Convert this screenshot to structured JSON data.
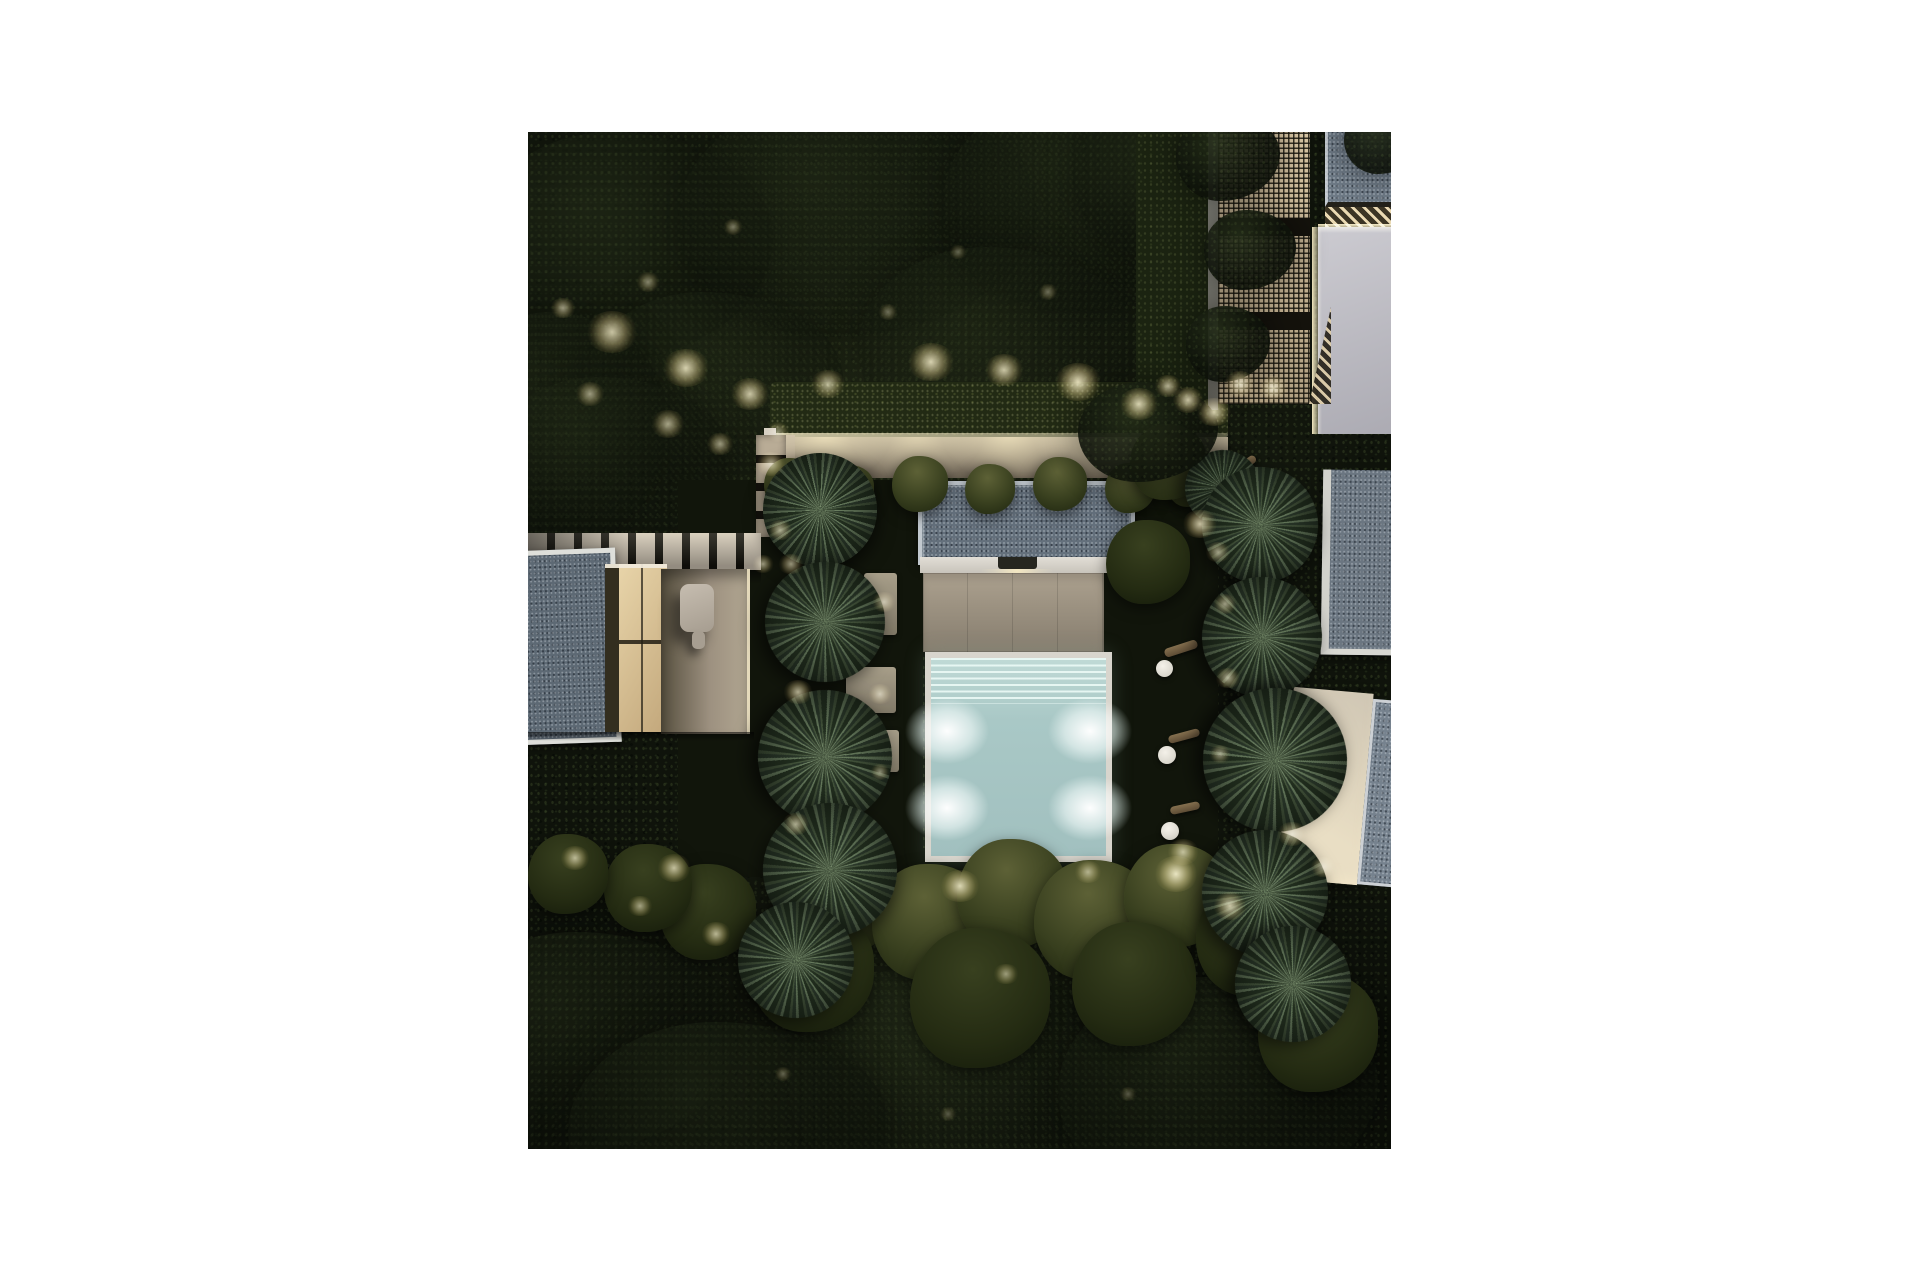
{
  "scene": {
    "caption": "Aerial night render of a modern villa garden: central illuminated pool with stepped entry, beige terrace, slate grey flat roofs, white modular loungers, yucca palm rows, lit hedges, pathways and dense dark tree canopy",
    "photo_rect": {
      "left": 528,
      "top": 132,
      "width": 863,
      "height": 1017
    },
    "palette": {
      "canopy_dark": "#0f130b",
      "lawn": "#11150b",
      "roof_slate": "#64707c",
      "roof_frame": "#c2c9cf",
      "wall_white": "#e2ded6",
      "terrace": "#aca18f",
      "path": "#b3a791",
      "slat_light": "#d3c9b8",
      "pool_coping": "#d8d5cd",
      "pool_water": "#a9c8c6",
      "pool_steps": "#c0dad6",
      "sofa": "#d9d5cb",
      "lattice": "#d8c6a4",
      "pale_wall": "#cccbd1",
      "trunk": "#85704f",
      "glow_core": "#fff6cd"
    },
    "vegetation": {
      "tree_canopies": [
        {
          "x": 95,
          "y": 115,
          "rx": 150,
          "ry": 115,
          "o": 0.5
        },
        {
          "x": 330,
          "y": 85,
          "rx": 180,
          "ry": 120,
          "o": 0.45
        },
        {
          "x": 565,
          "y": 70,
          "rx": 150,
          "ry": 110,
          "o": 0.5
        },
        {
          "x": 185,
          "y": 255,
          "rx": 130,
          "ry": 95,
          "o": 0.4
        },
        {
          "x": 470,
          "y": 215,
          "rx": 140,
          "ry": 100,
          "o": 0.4
        },
        {
          "x": 645,
          "y": 45,
          "rx": 100,
          "ry": 80,
          "o": 0.5
        },
        {
          "x": 30,
          "y": 300,
          "rx": 110,
          "ry": 120,
          "o": 0.5
        },
        {
          "x": 80,
          "y": 330,
          "rx": 120,
          "ry": 85,
          "o": 0.45
        },
        {
          "x": 60,
          "y": 910,
          "rx": 150,
          "ry": 110,
          "o": 0.55
        },
        {
          "x": 430,
          "y": 950,
          "rx": 170,
          "ry": 120,
          "o": 0.5
        },
        {
          "x": 690,
          "y": 960,
          "rx": 160,
          "ry": 115,
          "o": 0.5
        },
        {
          "x": 200,
          "y": 1000,
          "rx": 160,
          "ry": 110,
          "o": 0.5
        }
      ],
      "canopy_overlays": [
        {
          "x": 700,
          "y": 25,
          "rx": 52,
          "ry": 44
        },
        {
          "x": 722,
          "y": 118,
          "rx": 46,
          "ry": 40
        },
        {
          "x": 700,
          "y": 212,
          "rx": 42,
          "ry": 38
        },
        {
          "x": 856,
          "y": 8,
          "rx": 40,
          "ry": 34
        },
        {
          "x": 620,
          "y": 300,
          "rx": 70,
          "ry": 50
        }
      ],
      "bushes": [
        {
          "x": 262,
          "y": 352,
          "r": 26,
          "t": "moss"
        },
        {
          "x": 322,
          "y": 357,
          "r": 24,
          "t": "moss"
        },
        {
          "x": 392,
          "y": 352,
          "r": 28,
          "t": "moss"
        },
        {
          "x": 462,
          "y": 357,
          "r": 25,
          "t": "moss"
        },
        {
          "x": 532,
          "y": 352,
          "r": 27,
          "t": "moss"
        },
        {
          "x": 602,
          "y": 356,
          "r": 25,
          "t": "moss"
        },
        {
          "x": 662,
          "y": 352,
          "r": 23,
          "t": "moss"
        },
        {
          "x": 640,
          "y": 330,
          "r": 38,
          "t": "moss"
        },
        {
          "x": 620,
          "y": 430,
          "r": 42,
          "t": "dark"
        },
        {
          "x": 320,
          "y": 768,
          "r": 52,
          "t": "moss"
        },
        {
          "x": 402,
          "y": 790,
          "r": 58,
          "t": "moss"
        },
        {
          "x": 484,
          "y": 762,
          "r": 55,
          "t": "moss"
        },
        {
          "x": 566,
          "y": 788,
          "r": 60,
          "t": "moss"
        },
        {
          "x": 648,
          "y": 764,
          "r": 52,
          "t": "moss"
        },
        {
          "x": 284,
          "y": 838,
          "r": 62,
          "t": "dark"
        },
        {
          "x": 452,
          "y": 866,
          "r": 70,
          "t": "dark"
        },
        {
          "x": 606,
          "y": 852,
          "r": 62,
          "t": "dark"
        },
        {
          "x": 726,
          "y": 806,
          "r": 58,
          "t": "dark"
        },
        {
          "x": 180,
          "y": 780,
          "r": 48,
          "t": "dark"
        },
        {
          "x": 120,
          "y": 756,
          "r": 44,
          "t": "dark"
        },
        {
          "x": 40,
          "y": 742,
          "r": 40,
          "t": "dark"
        },
        {
          "x": 790,
          "y": 900,
          "r": 60,
          "t": "dark"
        }
      ],
      "palms": [
        {
          "x": 292,
          "y": 378,
          "r": 57,
          "rot": 0
        },
        {
          "x": 297,
          "y": 490,
          "r": 60,
          "rot": 40
        },
        {
          "x": 297,
          "y": 625,
          "r": 67,
          "rot": 80
        },
        {
          "x": 302,
          "y": 738,
          "r": 67,
          "rot": 15
        },
        {
          "x": 268,
          "y": 828,
          "r": 58,
          "rot": 55
        },
        {
          "x": 695,
          "y": 356,
          "r": 38,
          "rot": 95
        },
        {
          "x": 732,
          "y": 393,
          "r": 58,
          "rot": 25
        },
        {
          "x": 734,
          "y": 505,
          "r": 60,
          "rot": 65
        },
        {
          "x": 747,
          "y": 628,
          "r": 72,
          "rot": 105
        },
        {
          "x": 737,
          "y": 761,
          "r": 63,
          "rot": 35
        },
        {
          "x": 765,
          "y": 852,
          "r": 58,
          "rot": 75
        }
      ]
    },
    "lighting": {
      "garden_lights": [
        {
          "x": 84,
          "y": 200,
          "r": 26,
          "o": 0.8
        },
        {
          "x": 158,
          "y": 236,
          "r": 24,
          "o": 0.85
        },
        {
          "x": 222,
          "y": 262,
          "r": 20,
          "o": 0.8
        },
        {
          "x": 300,
          "y": 252,
          "r": 18,
          "o": 0.7
        },
        {
          "x": 403,
          "y": 230,
          "r": 24,
          "o": 0.85
        },
        {
          "x": 476,
          "y": 238,
          "r": 20,
          "o": 0.8
        },
        {
          "x": 550,
          "y": 250,
          "r": 24,
          "o": 0.9
        },
        {
          "x": 611,
          "y": 272,
          "r": 20,
          "o": 0.85
        },
        {
          "x": 660,
          "y": 268,
          "r": 16,
          "o": 0.8
        },
        {
          "x": 686,
          "y": 280,
          "r": 18,
          "o": 0.85
        },
        {
          "x": 712,
          "y": 252,
          "r": 16,
          "o": 0.8
        },
        {
          "x": 745,
          "y": 256,
          "r": 15,
          "o": 0.8
        },
        {
          "x": 640,
          "y": 254,
          "r": 14,
          "o": 0.7
        },
        {
          "x": 35,
          "y": 176,
          "r": 13,
          "o": 0.6
        },
        {
          "x": 120,
          "y": 150,
          "r": 12,
          "o": 0.5
        },
        {
          "x": 205,
          "y": 95,
          "r": 10,
          "o": 0.45
        },
        {
          "x": 62,
          "y": 262,
          "r": 15,
          "o": 0.6
        },
        {
          "x": 140,
          "y": 292,
          "r": 17,
          "o": 0.65
        },
        {
          "x": 192,
          "y": 312,
          "r": 14,
          "o": 0.6
        },
        {
          "x": 250,
          "y": 300,
          "r": 12,
          "o": 0.5
        },
        {
          "x": 360,
          "y": 180,
          "r": 10,
          "o": 0.4
        },
        {
          "x": 430,
          "y": 120,
          "r": 9,
          "o": 0.35
        },
        {
          "x": 520,
          "y": 160,
          "r": 10,
          "o": 0.4
        },
        {
          "x": 243,
          "y": 332,
          "r": 15,
          "o": 0.7
        },
        {
          "x": 252,
          "y": 398,
          "r": 13,
          "o": 0.65
        },
        {
          "x": 235,
          "y": 432,
          "r": 11,
          "o": 0.6
        },
        {
          "x": 672,
          "y": 392,
          "r": 18,
          "o": 0.8
        },
        {
          "x": 263,
          "y": 432,
          "r": 13,
          "o": 0.6
        },
        {
          "x": 356,
          "y": 470,
          "r": 12,
          "o": 0.6
        },
        {
          "x": 270,
          "y": 560,
          "r": 15,
          "o": 0.7
        },
        {
          "x": 352,
          "y": 562,
          "r": 12,
          "o": 0.6
        },
        {
          "x": 268,
          "y": 692,
          "r": 14,
          "o": 0.65
        },
        {
          "x": 352,
          "y": 640,
          "r": 10,
          "o": 0.5
        },
        {
          "x": 47,
          "y": 726,
          "r": 15,
          "o": 0.7
        },
        {
          "x": 146,
          "y": 736,
          "r": 17,
          "o": 0.75
        },
        {
          "x": 188,
          "y": 802,
          "r": 15,
          "o": 0.7
        },
        {
          "x": 112,
          "y": 774,
          "r": 13,
          "o": 0.6
        },
        {
          "x": 432,
          "y": 754,
          "r": 20,
          "o": 0.85
        },
        {
          "x": 560,
          "y": 740,
          "r": 14,
          "o": 0.6
        },
        {
          "x": 648,
          "y": 742,
          "r": 22,
          "o": 0.9
        },
        {
          "x": 702,
          "y": 774,
          "r": 17,
          "o": 0.8
        },
        {
          "x": 478,
          "y": 842,
          "r": 13,
          "o": 0.55
        },
        {
          "x": 655,
          "y": 720,
          "r": 16,
          "o": 0.7
        },
        {
          "x": 690,
          "y": 420,
          "r": 13,
          "o": 0.6
        },
        {
          "x": 697,
          "y": 472,
          "r": 12,
          "o": 0.6
        },
        {
          "x": 700,
          "y": 546,
          "r": 13,
          "o": 0.65
        },
        {
          "x": 692,
          "y": 622,
          "r": 11,
          "o": 0.55
        },
        {
          "x": 764,
          "y": 702,
          "r": 15,
          "o": 0.7
        },
        {
          "x": 795,
          "y": 735,
          "r": 13,
          "o": 0.6
        },
        {
          "x": 255,
          "y": 942,
          "r": 9,
          "o": 0.35
        },
        {
          "x": 420,
          "y": 982,
          "r": 9,
          "o": 0.3
        },
        {
          "x": 600,
          "y": 962,
          "r": 9,
          "o": 0.3
        }
      ],
      "pool_lights": [
        {
          "x": 9,
          "y": 37
        },
        {
          "x": 91,
          "y": 37
        },
        {
          "x": 9,
          "y": 76
        },
        {
          "x": 91,
          "y": 76
        }
      ]
    },
    "furniture": {
      "sofa_groups": [
        {
          "x": 599,
          "y": 470,
          "rot": 1.5
        },
        {
          "x": 600,
          "y": 551,
          "rot": -2
        },
        {
          "x": 601,
          "y": 632,
          "rot": 1
        }
      ],
      "side_tables": [
        {
          "x": 628,
          "y": 528,
          "d": 17
        },
        {
          "x": 630,
          "y": 614,
          "d": 18
        },
        {
          "x": 633,
          "y": 690,
          "d": 18
        }
      ],
      "step_pads": [
        {
          "x": 336,
          "y": 441,
          "w": 33,
          "h": 62
        },
        {
          "x": 318,
          "y": 535,
          "w": 50,
          "h": 46
        },
        {
          "x": 331,
          "y": 598,
          "w": 40,
          "h": 42
        }
      ],
      "palm_trunks": [
        {
          "x": 636,
          "y": 512,
          "w": 34,
          "h": 9,
          "rot": -18
        },
        {
          "x": 640,
          "y": 600,
          "w": 32,
          "h": 8,
          "rot": -15
        },
        {
          "x": 642,
          "y": 672,
          "w": 30,
          "h": 8,
          "rot": -12
        },
        {
          "x": 700,
          "y": 330,
          "w": 30,
          "h": 8,
          "rot": -35
        }
      ]
    }
  }
}
